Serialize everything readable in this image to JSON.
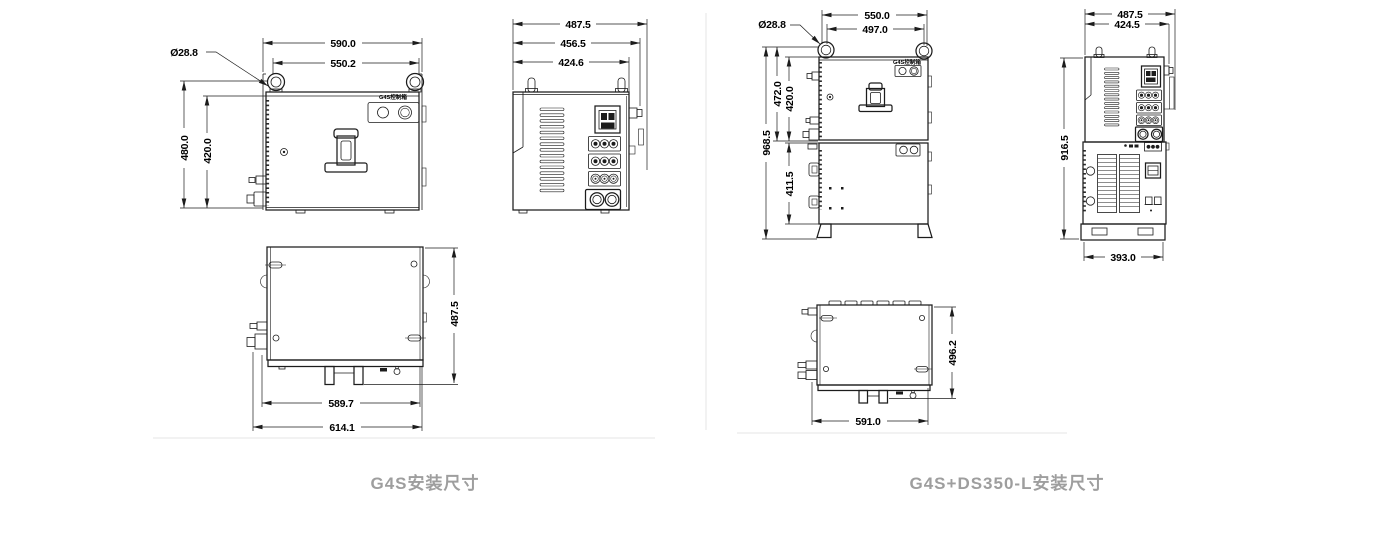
{
  "captions": {
    "left": "G4S安装尺寸",
    "right": "G4S+DS350-L安装尺寸"
  },
  "left_figure": {
    "front": {
      "label": "G4S控制箱",
      "width_overall": "590.0",
      "width_inner": "550.2",
      "hole_dia": "Ø28.8",
      "height_overall": "480.0",
      "height_inner": "420.0"
    },
    "side": {
      "depth_overall": "487.5",
      "depth_mid": "456.5",
      "depth_body": "424.6"
    },
    "bottom": {
      "depth": "487.5",
      "width_body": "589.7",
      "width_overall": "614.1"
    }
  },
  "right_figure": {
    "front": {
      "label": "G4S控制箱",
      "width_overall": "550.0",
      "width_inner": "497.0",
      "hole_dia": "Ø28.8",
      "height_overall": "968.5",
      "height_upper_overall": "472.0",
      "height_upper": "420.0",
      "height_lower": "411.5"
    },
    "side": {
      "depth_overall": "487.5",
      "depth_body": "424.5",
      "height_body": "916.5",
      "base_width": "393.0"
    },
    "bottom": {
      "depth": "496.2",
      "width": "591.0"
    }
  }
}
